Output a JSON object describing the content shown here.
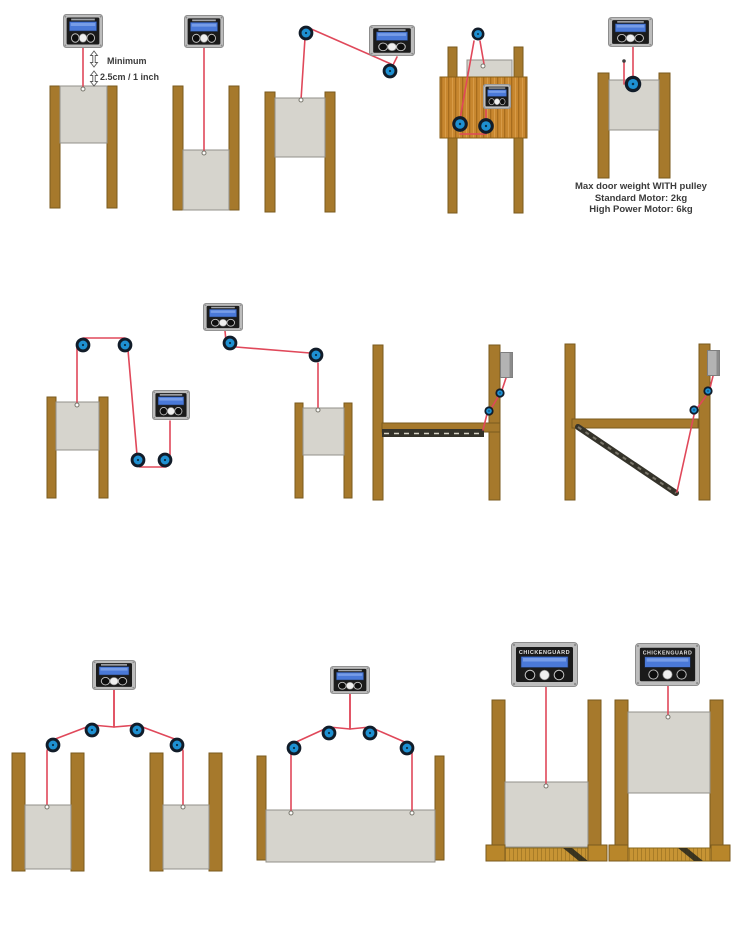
{
  "canvas": {
    "width": 745,
    "height": 930,
    "background": "#ffffff"
  },
  "device": {
    "brand": "ChickenGuard"
  },
  "annotations": {
    "minimum": {
      "line1": "Minimum",
      "line2": "2.5cm / 1 inch"
    },
    "max_weight": {
      "line1": "Max door weight WITH pulley",
      "line2": "Standard Motor: 2kg",
      "line3": "High Power Motor: 6kg"
    }
  },
  "colors": {
    "background": "#ffffff",
    "cord": "#e0485a",
    "pulley_blue": "#1e90d2",
    "pulley_ring": "#111c29",
    "post": "#a6792c",
    "post_border": "#7a5a1e",
    "door": "#d6d4cd",
    "door_border": "#93918a",
    "unit_body": "#bdbdbd",
    "unit_panel": "#1b1b1b",
    "unit_screen": "#4a79d8",
    "wood_panel": "#c8872f",
    "base_wood": "#c79434",
    "ramp_dark": "#35332a",
    "text": "#3b3b3b"
  },
  "figures": [
    {
      "id": "door-closed-unit-above",
      "row": 1
    },
    {
      "id": "door-open-unit-above",
      "row": 1
    },
    {
      "id": "door-side-unit-two-pulleys",
      "row": 1
    },
    {
      "id": "door-wall-mounted-unit-three-pulleys",
      "row": 1
    },
    {
      "id": "door-with-pulley-on-door",
      "row": 1
    },
    {
      "id": "door-rear-unit-four-pulleys",
      "row": 2
    },
    {
      "id": "door-offset-unit-two-pulleys",
      "row": 2
    },
    {
      "id": "ramp-door-raised",
      "row": 2
    },
    {
      "id": "ramp-door-lowered",
      "row": 2
    },
    {
      "id": "twin-doors-single-unit",
      "row": 3
    },
    {
      "id": "wide-door-two-lift-points",
      "row": 3
    },
    {
      "id": "framed-door-closed",
      "row": 3
    },
    {
      "id": "framed-door-open",
      "row": 3
    }
  ]
}
